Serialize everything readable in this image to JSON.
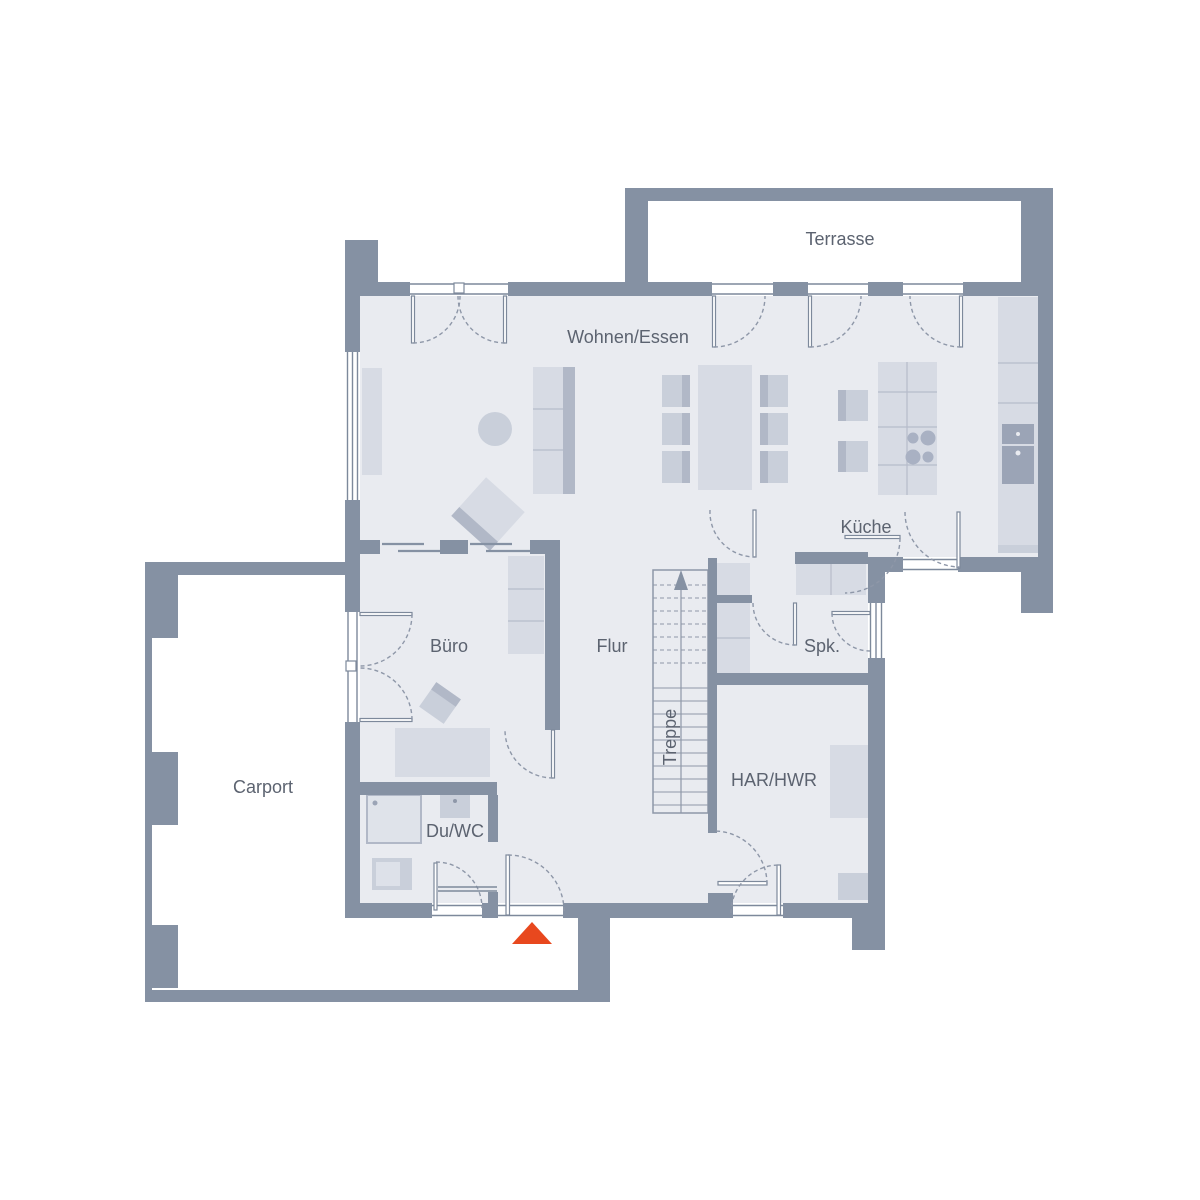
{
  "plan": {
    "labels": {
      "terrasse": "Terrasse",
      "wohnen_essen": "Wohnen/Essen",
      "kueche": "Küche",
      "buero": "Büro",
      "flur": "Flur",
      "spk": "Spk.",
      "treppe": "Treppe",
      "har_hwr": "HAR/HWR",
      "du_wc": "Du/WC",
      "carport": "Carport"
    },
    "colors": {
      "wall": "#8591a3",
      "floor": "#e9ebf0",
      "furniture": "#d7dbe4",
      "furniture_dark": "#b1b8c7",
      "appliance": "#9ba4b6",
      "line": "#7d899b",
      "text": "#5c6370",
      "entrance_marker": "#e8481e",
      "background": "#ffffff"
    },
    "markers": {
      "entrance_arrow": "entrance",
      "stairs_direction": "up"
    }
  }
}
